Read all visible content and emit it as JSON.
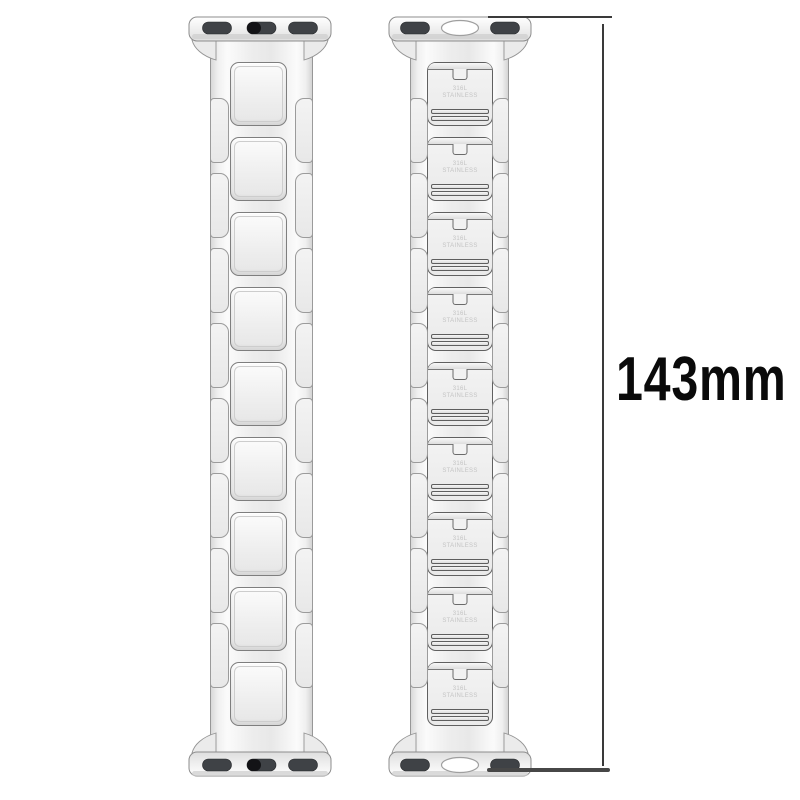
{
  "measurement": {
    "label": "143mm"
  },
  "product": {
    "front_band": {
      "link_count": 9,
      "side_link_count": 8,
      "adapter_slot_count": 3
    },
    "back_band": {
      "link_count": 9,
      "side_link_count": 8,
      "adapter_slot_count": 2,
      "adapter_has_center_oval": true,
      "engraving": {
        "line1": "316L",
        "line2": "STAINLESS"
      }
    }
  },
  "colors": {
    "background": "#ffffff",
    "metal_light": "#f2f2f2",
    "metal_outline": "#8f8f8f",
    "slot_dark": "#3f4246",
    "dimension_line": "#3a3a3a",
    "label_text": "#0a0a0a",
    "engraving_text": "#c4c4c4"
  }
}
